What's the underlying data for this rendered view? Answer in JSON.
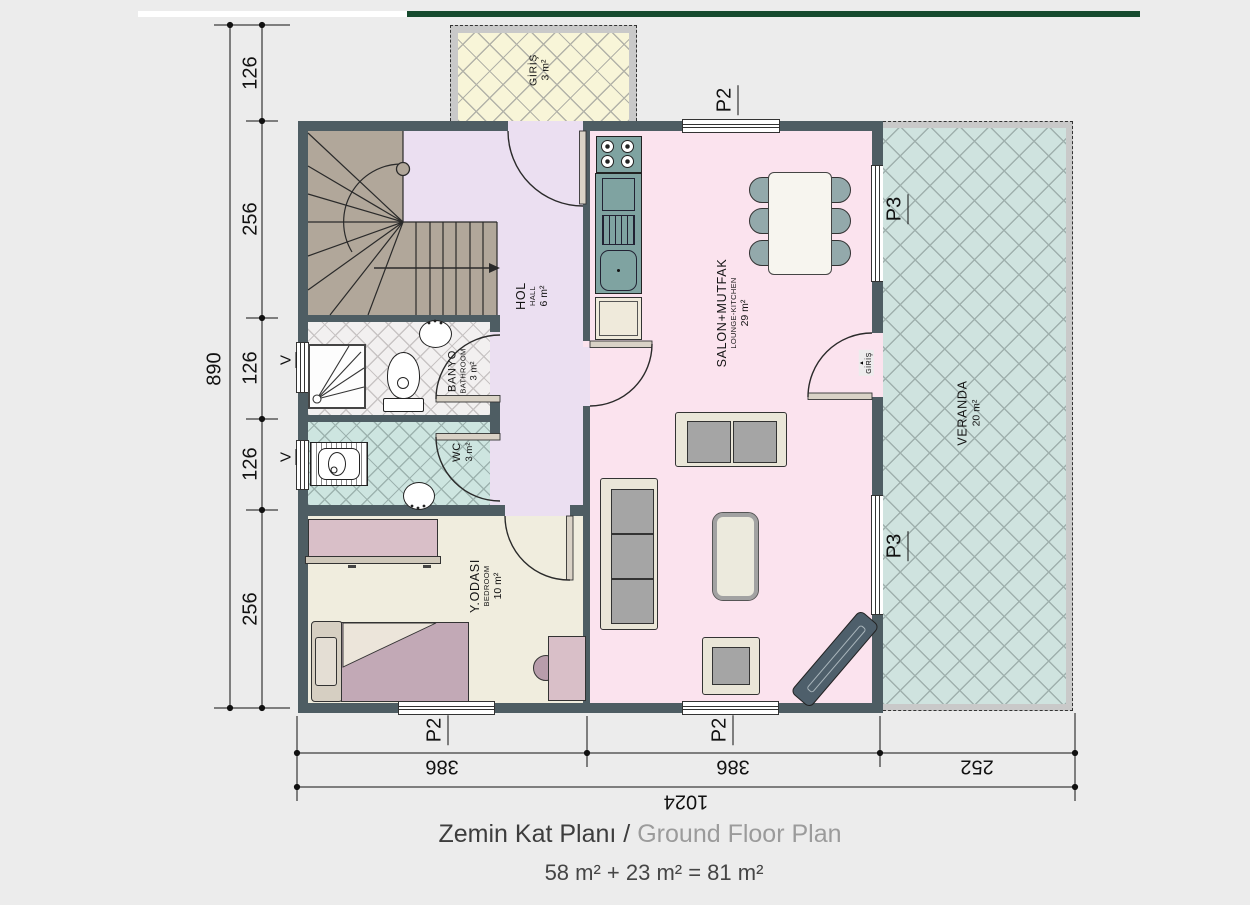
{
  "accent": {
    "green_bar": "#164a2e"
  },
  "rooms": [
    {
      "name": "GİRİŞ",
      "sub": "",
      "area": "3 m²"
    },
    {
      "name": "HOL",
      "sub": "HALL",
      "area": "6 m²"
    },
    {
      "name": "SALON+MUTFAK",
      "sub": "LOUNGE-KITCHEN",
      "area": "29 m²"
    },
    {
      "name": "BANYO",
      "sub": "BATHROOM",
      "area": "3 m²"
    },
    {
      "name": "WC",
      "sub": "",
      "area": "3 m²"
    },
    {
      "name": "Y.ODASI",
      "sub": "BEDROOM",
      "area": "10 m²"
    },
    {
      "name": "VERANDA",
      "sub": "",
      "area": "20 m²"
    }
  ],
  "entry": {
    "arrow": "▲",
    "text": "GİRİŞ"
  },
  "openings": {
    "p2": "P2",
    "p3": "P3",
    "v": "V"
  },
  "dimensions": {
    "left": {
      "segments": [
        "126",
        "256",
        "126",
        "126",
        "256"
      ],
      "total": "890"
    },
    "bottom": {
      "segments": [
        "386",
        "386",
        "252"
      ],
      "total": "1024"
    }
  },
  "title": {
    "tr": "Zemin Kat Planı /",
    "en": "Ground Floor Plan"
  },
  "area_summary": "58 m² + 23 m² = 81 m²"
}
